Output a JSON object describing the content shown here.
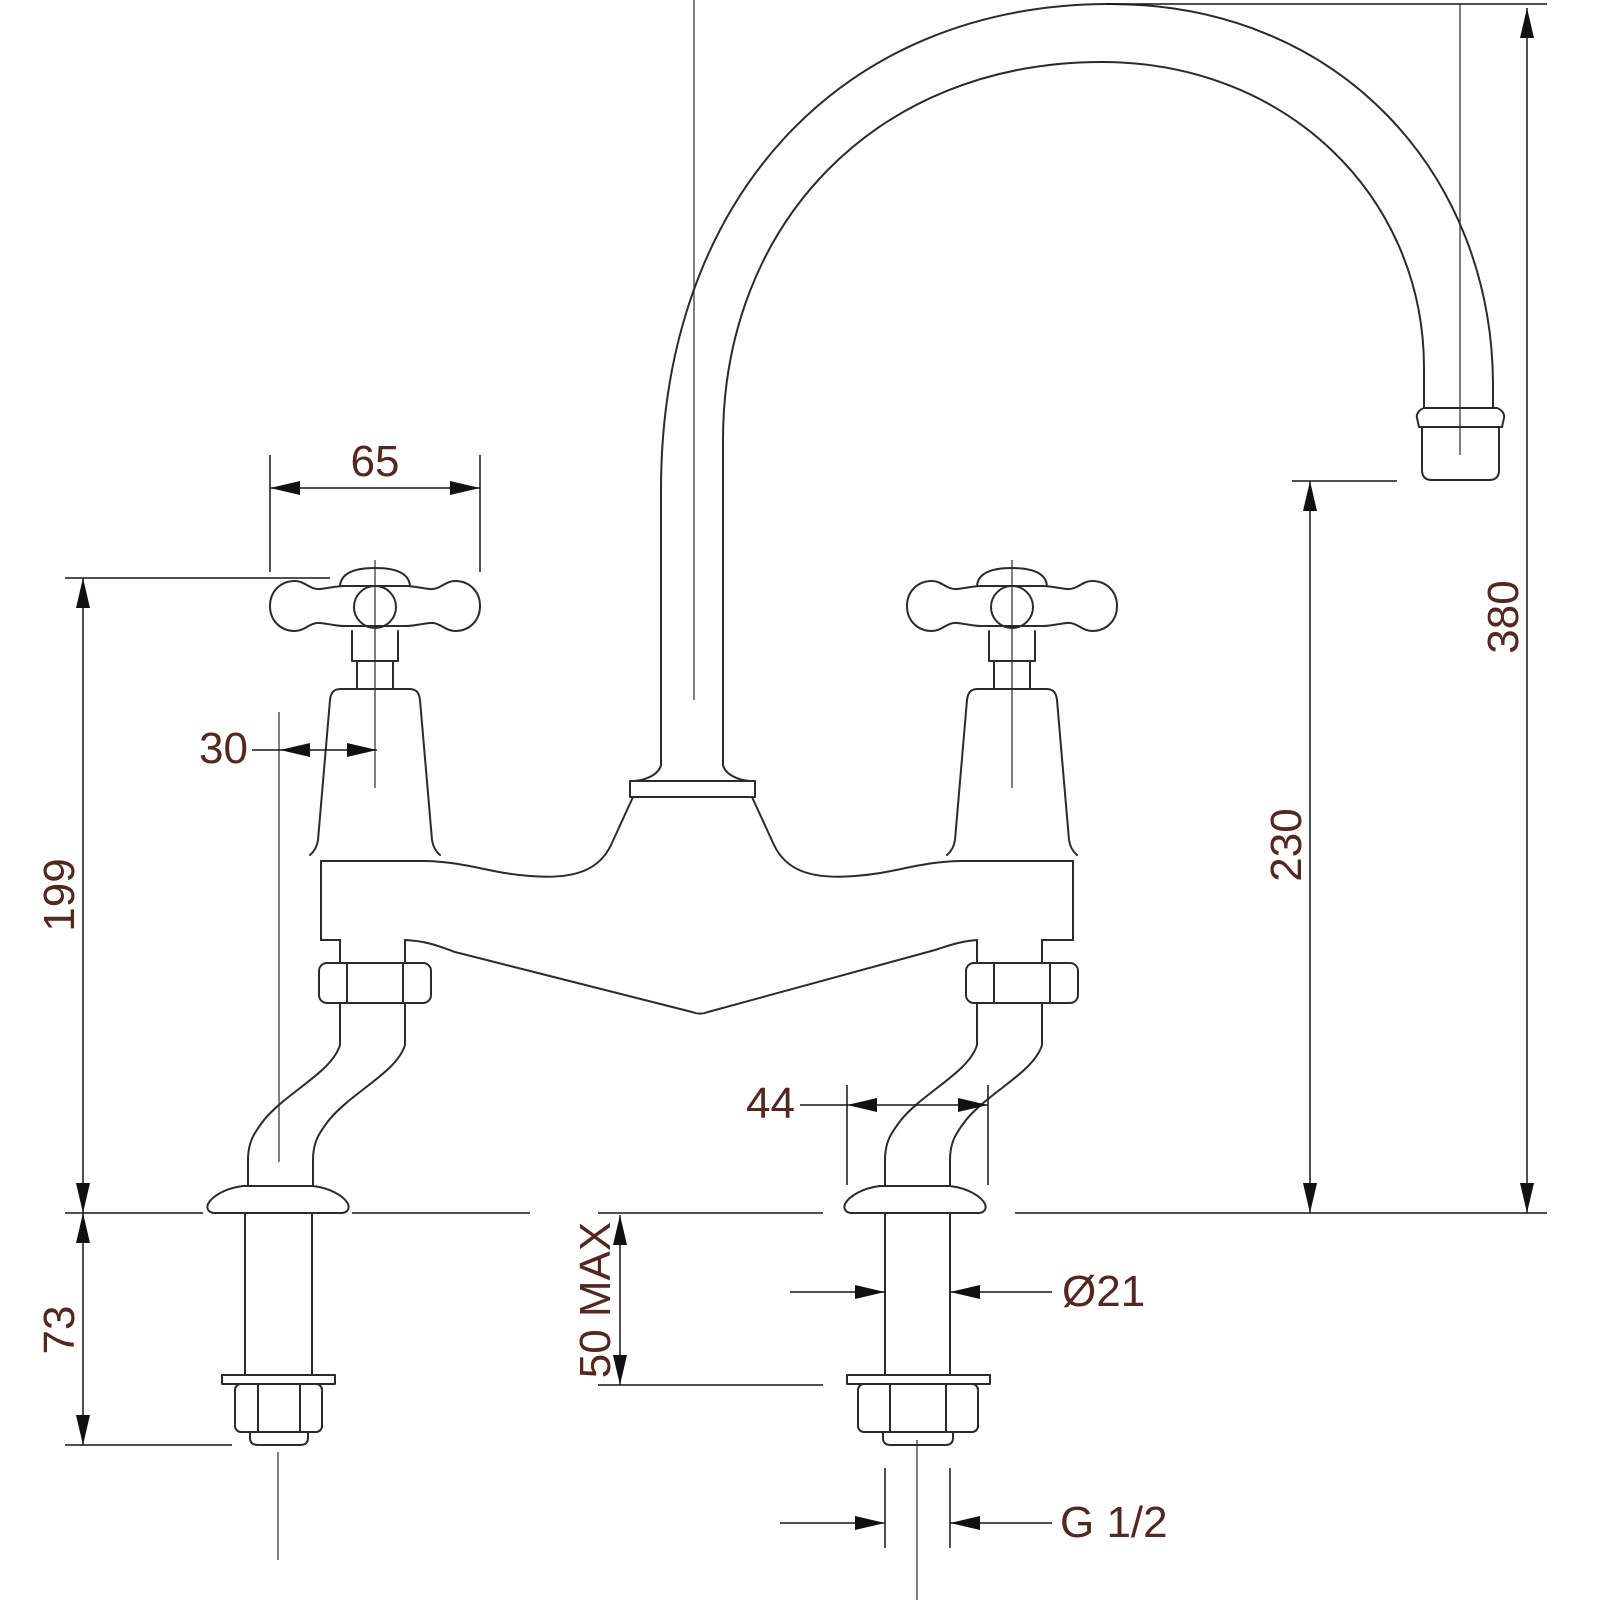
{
  "drawing": {
    "type": "technical-drawing",
    "subject": "Bridge kitchen mixer tap with crosshead handles and swan-neck spout, dimensioned front elevation",
    "dimensions": {
      "handle_width": "65",
      "handle_to_inlet_offset": "30",
      "deck_to_handle_height": "199",
      "below_deck_length": "73",
      "base_flange_diameter": "44",
      "max_deck_thickness": "50 MAX",
      "shank_diameter": "Ø21",
      "overall_spout_height": "380",
      "spout_outlet_height": "230",
      "inlet_thread": "G 1/2"
    },
    "colors": {
      "line": "#2b2b2b",
      "dimension_text": "#53281f",
      "background": "#ffffff"
    }
  }
}
